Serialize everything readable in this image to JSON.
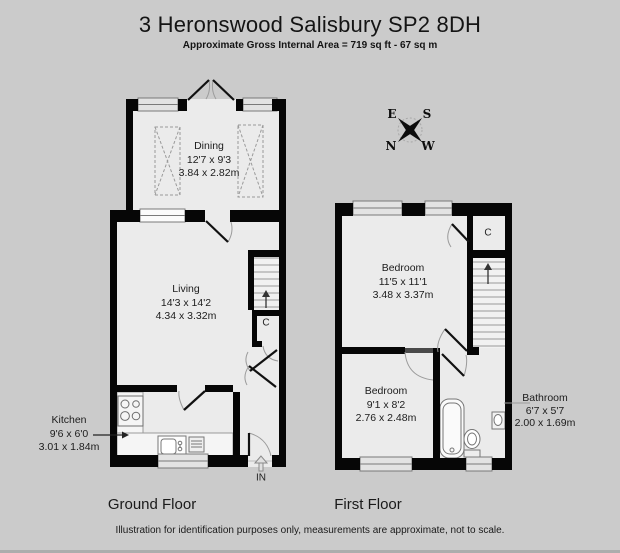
{
  "header": {
    "title": "3 Heronswood Salisbury SP2 8DH",
    "subtitle": "Approximate Gross Internal Area = 719 sq ft - 67 sq m"
  },
  "compass": {
    "east": "E",
    "south": "S",
    "north": "N",
    "west": "W"
  },
  "ground_floor": {
    "label": "Ground Floor",
    "closet_label": "C",
    "entrance_label": "IN",
    "rooms": {
      "dining": {
        "name": "Dining",
        "imperial": "12'7 x 9'3",
        "metric": "3.84 x 2.82m"
      },
      "living": {
        "name": "Living",
        "imperial": "14'3 x 14'2",
        "metric": "4.34 x 3.32m"
      },
      "kitchen": {
        "name": "Kitchen",
        "imperial": "9'6 x 6'0",
        "metric": "3.01 x 1.84m"
      }
    }
  },
  "first_floor": {
    "label": "First Floor",
    "closet_label": "C",
    "rooms": {
      "bedroom_front": {
        "name": "Bedroom",
        "imperial": "11'5 x 11'1",
        "metric": "3.48 x 3.37m"
      },
      "bedroom_back": {
        "name": "Bedroom",
        "imperial": "9'1 x 8'2",
        "metric": "2.76 x 2.48m"
      },
      "bathroom": {
        "name": "Bathroom",
        "imperial": "6'7 x 5'7",
        "metric": "2.00 x 1.69m"
      }
    }
  },
  "footer": {
    "disclaimer": "Illustration for identification purposes only, measurements are approximate, not to scale."
  }
}
